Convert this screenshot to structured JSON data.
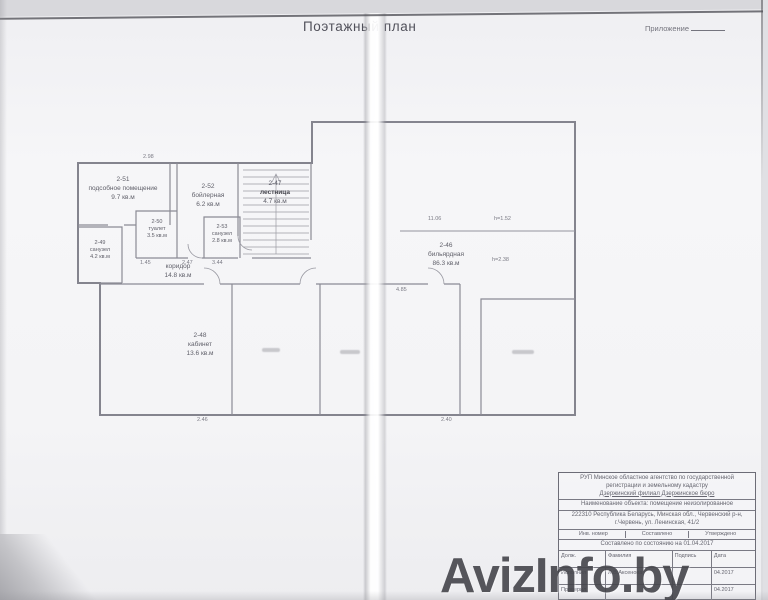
{
  "document": {
    "title": "Поэтажный план",
    "appendix_label": "Приложение",
    "watermark": "AvizInfo.by"
  },
  "plan": {
    "rooms": [
      {
        "num": "2-51",
        "name": "подсобное помещение",
        "area": "9.7 кв.м"
      },
      {
        "num": "2-52",
        "name": "бойлерная",
        "area": "6.2 кв.м"
      },
      {
        "num": "2-50",
        "name": "туалет",
        "area": "3.5 кв.м"
      },
      {
        "num": "2-49",
        "name": "санузел",
        "area": "4.2 кв.м"
      },
      {
        "num": "2-53",
        "name": "санузел",
        "area": "2.8 кв.м"
      },
      {
        "num": "2-47",
        "name": "лестница",
        "area": "4.7 кв.м"
      },
      {
        "num": "",
        "name": "коридор",
        "area": "14.8 кв.м"
      },
      {
        "num": "2-48",
        "name": "кабинет",
        "area": "13.6 кв.м"
      },
      {
        "num": "2-46",
        "name": "бильярдная",
        "area": "86.3 кв.м"
      }
    ],
    "dimensions": [
      "2.98",
      "1.45",
      "2.47",
      "3.44",
      "11.06",
      "h=1.52",
      "h=2.38",
      "4.85",
      "2.46",
      "2.40"
    ]
  },
  "stamp": {
    "org_line1": "РУП Минское областное агентство по государственной",
    "org_line2": "регистрации и земельному кадастру",
    "org_line3": "Дзержинский филиал    Дзержинское    бюро",
    "object_line": "Наименование объекта: помещение неизолированное",
    "address_line1": "222310 Республика Беларусь, Минская обл., Червенский р-н,",
    "address_line2": "г.Червень, ул. Ленинская, 41/2",
    "inv_cells": [
      "Инв. номер",
      "Составлено",
      "Утверждено"
    ],
    "date_line": "Составлено по состоянию на 01.04.2017",
    "table_rows": [
      [
        "Долж.",
        "Фамилия",
        "Подпись",
        "Дата"
      ],
      [
        "Исполнил",
        "Л.В.Аксенова",
        "",
        "04.2017"
      ],
      [
        "Проверил",
        "",
        "",
        "04.2017"
      ]
    ]
  }
}
